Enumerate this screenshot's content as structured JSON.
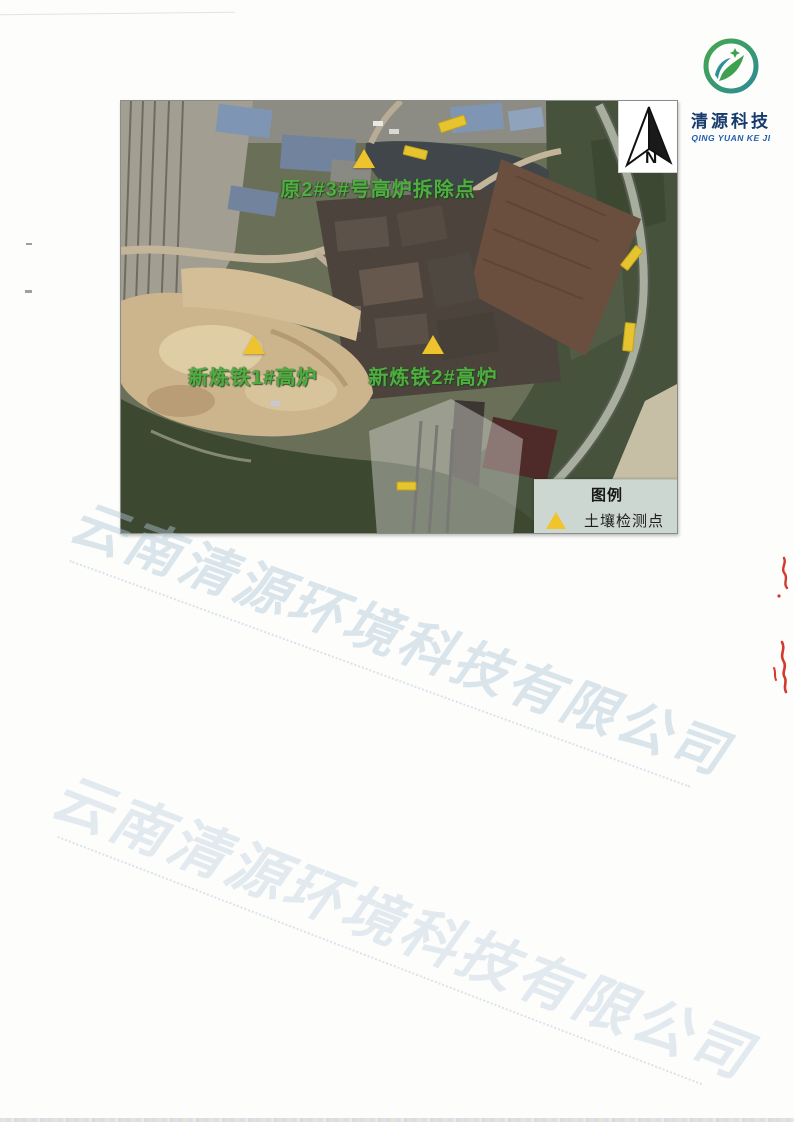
{
  "logo": {
    "company_cn": "清源科技",
    "company_en": "QING YUAN KE JI"
  },
  "map": {
    "compass_label": "N",
    "points": [
      {
        "id": "demolished-furnace",
        "label": "原2#3#号高炉拆除点"
      },
      {
        "id": "new-furnace-1",
        "label": "新炼铁1#高炉"
      },
      {
        "id": "new-furnace-2",
        "label": "新炼铁2#高炉"
      }
    ],
    "legend": {
      "title": "图例",
      "items": [
        {
          "marker_icon": "yellow-triangle",
          "label": "土壤检测点"
        }
      ]
    },
    "colors": {
      "marker": "#EEC32D",
      "point_label": "#4FAE3F",
      "legend_bg": "#CCD7D1"
    }
  },
  "watermark": {
    "text": "云南清源环境科技有限公司"
  }
}
